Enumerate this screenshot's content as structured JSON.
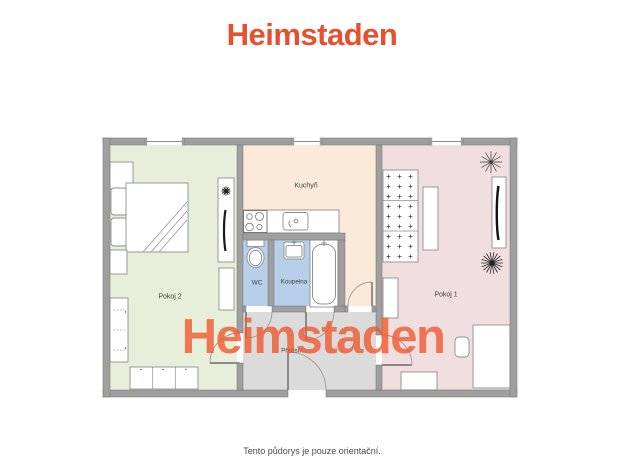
{
  "header": {
    "logo": "Heimstaden"
  },
  "watermark": {
    "text": "Heimstaden"
  },
  "colors": {
    "logo": "#e8502d",
    "watermark": "#f05a2e",
    "wall": "#9f9f9f",
    "pokoj2": "#e7eeda",
    "kuchyn": "#fbe9d9",
    "pokoj1": "#f1dede",
    "bath": "#b7cfe9",
    "predsin": "#dbdbdc"
  },
  "rooms": {
    "pokoj2": {
      "label": "Pokoj 2"
    },
    "kuchyn": {
      "label": "Kuchyň"
    },
    "pokoj1": {
      "label": "Pokoj 1"
    },
    "wc": {
      "label": "WC"
    },
    "koupelna": {
      "label": "Koupelna"
    },
    "predsin": {
      "label": "Předsíň"
    }
  },
  "footer": {
    "disclaimer": "Tento půdorys je pouze orientační."
  }
}
